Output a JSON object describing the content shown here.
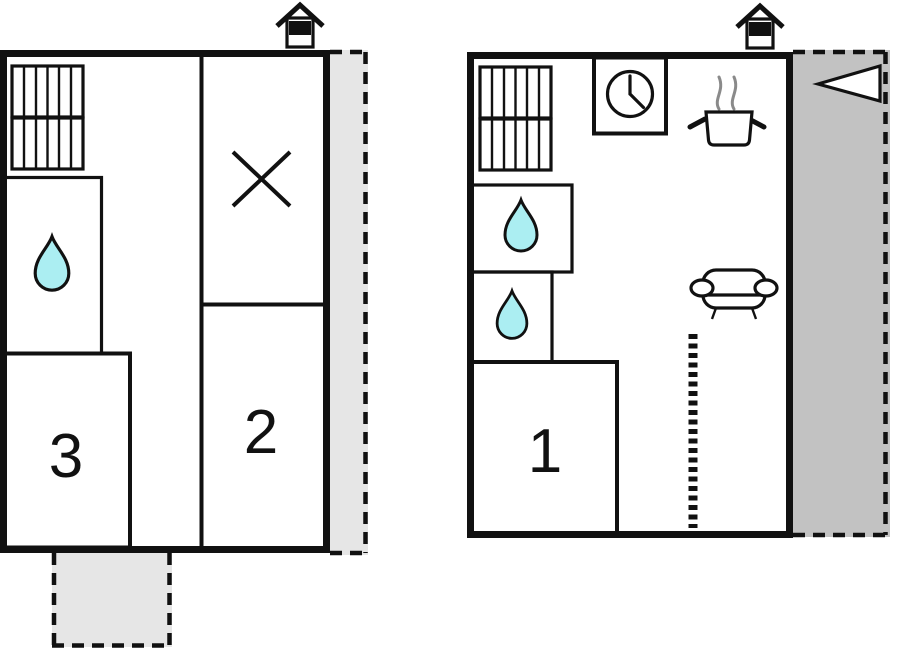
{
  "colors": {
    "ink": "#111111",
    "background": "#ffffff",
    "outdoor_light": "#e6e6e6",
    "outdoor_dark": "#c2c2c2",
    "water_drop": "#abeef2",
    "steam": "#8a8a8a"
  },
  "left_unit": {
    "name": "left-floor-plan",
    "rooms": [
      {
        "id": "room-2",
        "label": "2"
      },
      {
        "id": "room-3",
        "label": "3"
      }
    ],
    "icons": [
      "house-entrance-icon",
      "radiator-icon",
      "water-drop-icon",
      "cross-icon"
    ],
    "outdoor_areas": [
      "terrace-right",
      "terrace-bottom"
    ]
  },
  "right_unit": {
    "name": "right-floor-plan",
    "rooms": [
      {
        "id": "room-1",
        "label": "1"
      }
    ],
    "icons": [
      "house-entrance-icon",
      "radiator-icon",
      "clock-icon",
      "cooking-pot-icon",
      "water-drop-icon",
      "water-drop-icon",
      "sofa-icon",
      "ladder-icon",
      "direction-arrow-icon"
    ],
    "outdoor_areas": [
      "terrace-right"
    ]
  }
}
